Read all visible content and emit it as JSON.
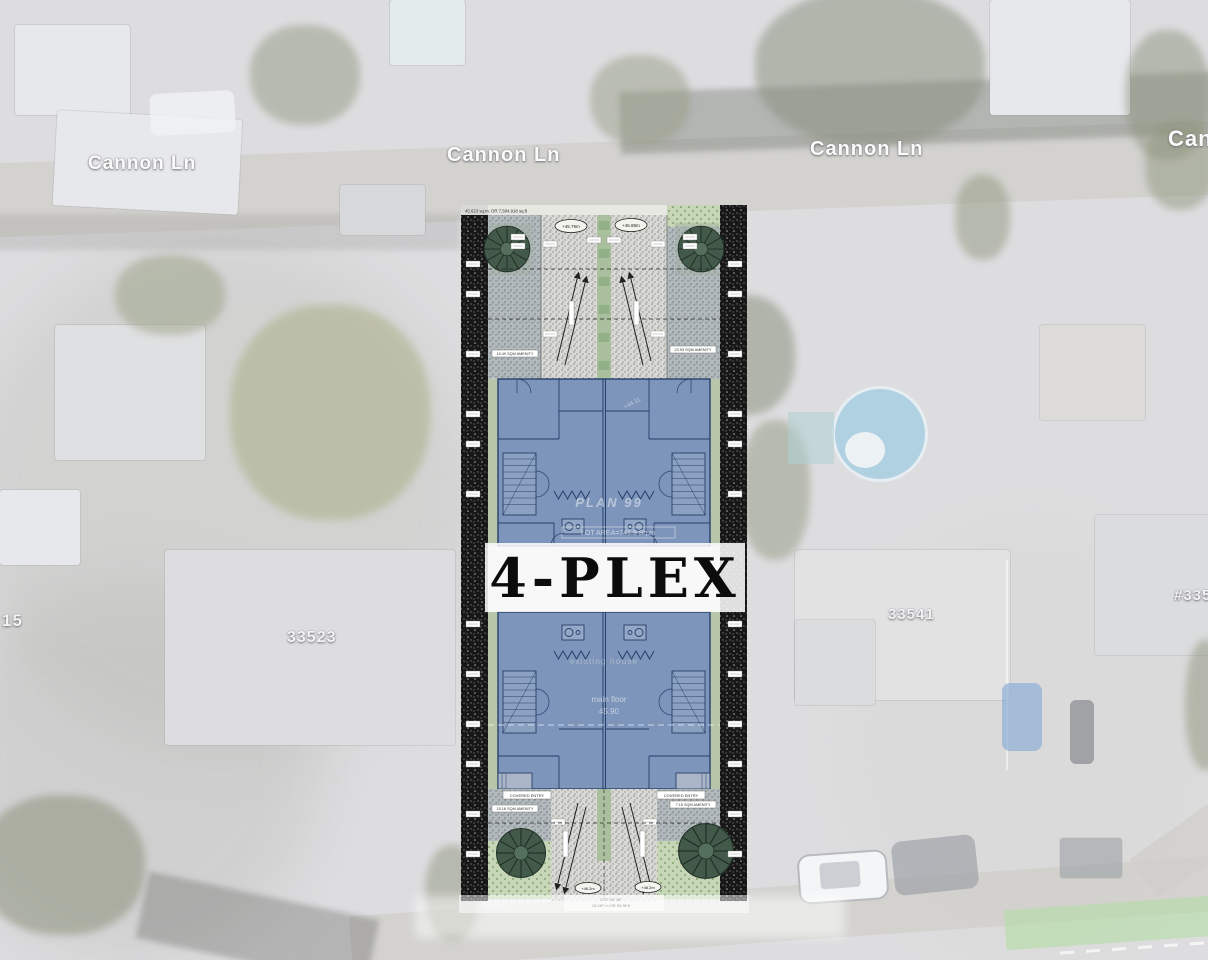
{
  "map": {
    "street_labels": [
      "Cannon Ln",
      "Cannon Ln",
      "Cannon Ln",
      "Can"
    ],
    "address_labels": [
      "15",
      "33523",
      "33541",
      "#335"
    ]
  },
  "site_plan": {
    "banner_text": "4-PLEX",
    "lot_note_top": "45.623 sq.m. OR 7,584.918 sq.ft",
    "deciduous_note": "35 deciduous",
    "grade_top_left": "+45.79m",
    "grade_top_right": "+45.88m",
    "grade_bottom_left": "+46.2m",
    "grade_bottom_right": "+46.2m",
    "elevation_note": "+44.11",
    "plan_number": "PLAN 99",
    "lot_area": "LOT AREA=741.9 Sq.m",
    "existing_house": "existing house",
    "main_floor_label": "main floor",
    "main_floor_value": "45.90",
    "amenity_top_left": "15.49 SQM AMENITY",
    "amenity_top_right": "23.93 SQM AMENITY",
    "amenity_bottom_left": "15.16 SQM AMENITY",
    "amenity_bottom_right": "7.15 SQM AMENITY",
    "covered_entry_left": "COVERED ENTRY",
    "covered_entry_right": "COVERED ENTRY",
    "bearing_bottom": "270° 04' 18\"",
    "dimension_bottom": "18.287 m OR 59.99 ft",
    "colors": {
      "building_fill": "#7d95ba",
      "wall_line": "#26406b",
      "tree_green": "#43594a",
      "landscape_green": "#c6d6b6",
      "banner_bg": "#ffffff",
      "banner_text": "#0c0c0c",
      "pool_blue": "#8fc3de"
    }
  }
}
